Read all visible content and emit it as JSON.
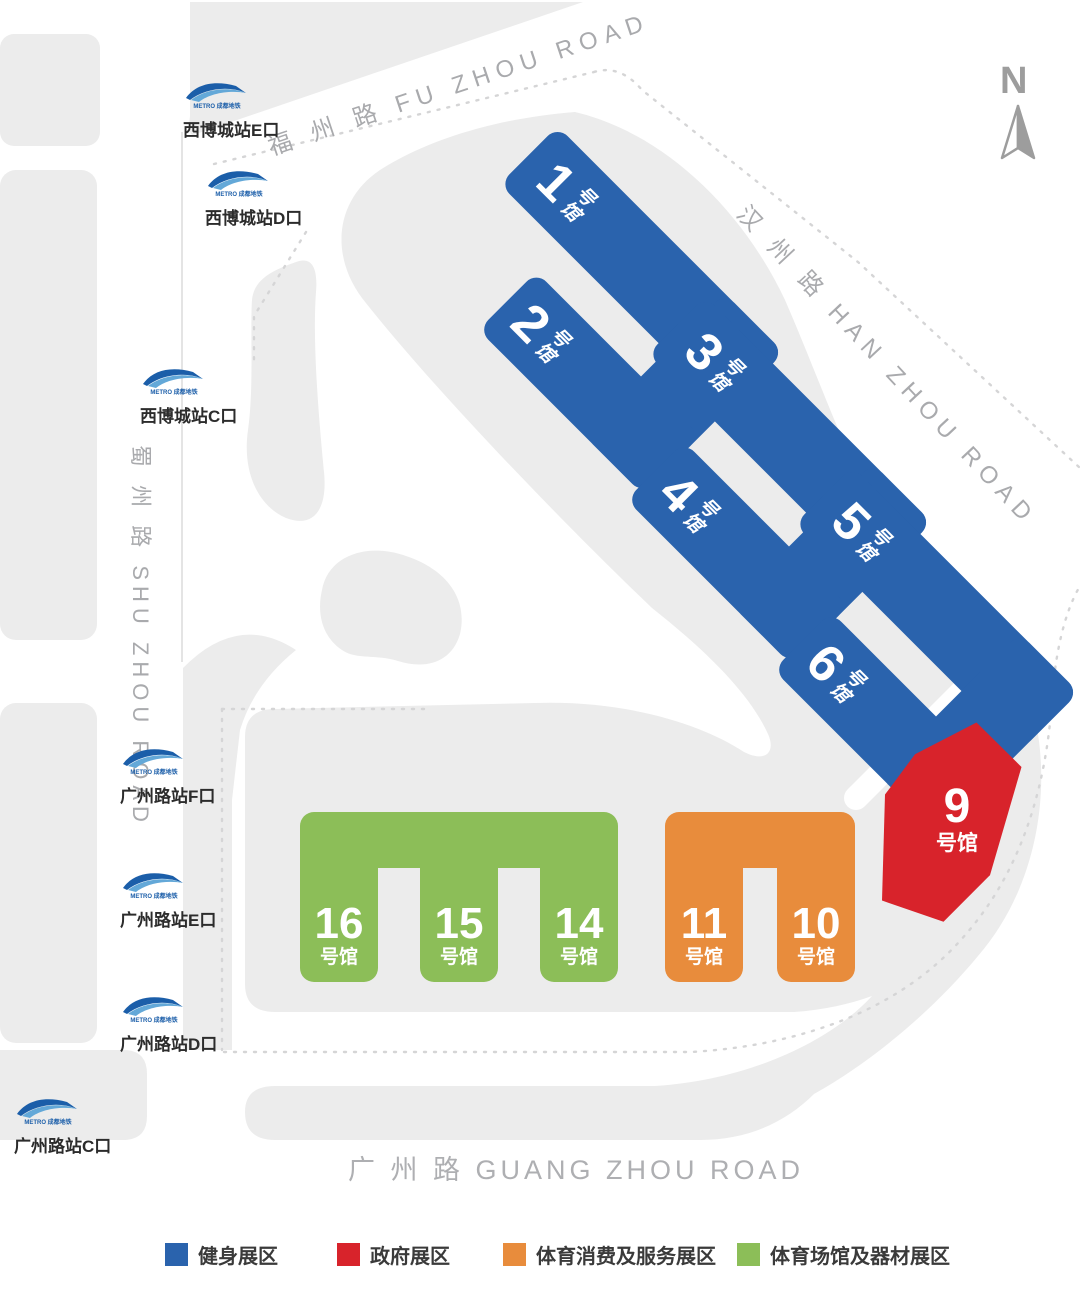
{
  "north": {
    "label": "N"
  },
  "roads": {
    "fuzhou": "福 州 路 FU ZHOU ROAD",
    "hanzhou": "汉 州 路 HAN ZHOU ROAD",
    "shuzhou": "蜀 州 路 SHU ZHOU ROAD",
    "guangzhou": "广 州 路 GUANG ZHOU ROAD"
  },
  "metro_brand": "METRO 成都地铁",
  "stations": {
    "xibo_e": "西博城站E口",
    "xibo_d": "西博城站D口",
    "xibo_c": "西博城站C口",
    "gzl_f": "广州路站F口",
    "gzl_e": "广州路站E口",
    "gzl_d": "广州路站D口",
    "gzl_c": "广州路站C口"
  },
  "halls": {
    "h1": {
      "num": "1",
      "s1": "号",
      "s2": "馆"
    },
    "h2": {
      "num": "2",
      "s1": "号",
      "s2": "馆"
    },
    "h3": {
      "num": "3",
      "s1": "号",
      "s2": "馆"
    },
    "h4": {
      "num": "4",
      "s1": "号",
      "s2": "馆"
    },
    "h5": {
      "num": "5",
      "s1": "号",
      "s2": "馆"
    },
    "h6": {
      "num": "6",
      "s1": "号",
      "s2": "馆"
    },
    "h9": {
      "num": "9",
      "suffix": "号馆"
    },
    "h10": {
      "num": "10",
      "suffix": "号馆"
    },
    "h11": {
      "num": "11",
      "suffix": "号馆"
    },
    "h14": {
      "num": "14",
      "suffix": "号馆"
    },
    "h15": {
      "num": "15",
      "suffix": "号馆"
    },
    "h16": {
      "num": "16",
      "suffix": "号馆"
    }
  },
  "legend": {
    "fitness": {
      "label": "健身展区",
      "color": "#2a63ad"
    },
    "government": {
      "label": "政府展区",
      "color": "#d8232b"
    },
    "consumption": {
      "label": "体育消费及服务展区",
      "color": "#e88c3c"
    },
    "venues": {
      "label": "体育场馆及器材展区",
      "color": "#8cbe58"
    }
  },
  "colors": {
    "hall_blue": "#2a63ad",
    "hall_red": "#d8232b",
    "hall_orange": "#e88c3c",
    "hall_green": "#8cbe58",
    "map_gray": "#ececec",
    "road_text": "#a9aaad",
    "metro_blue": "#1b5ea9"
  }
}
